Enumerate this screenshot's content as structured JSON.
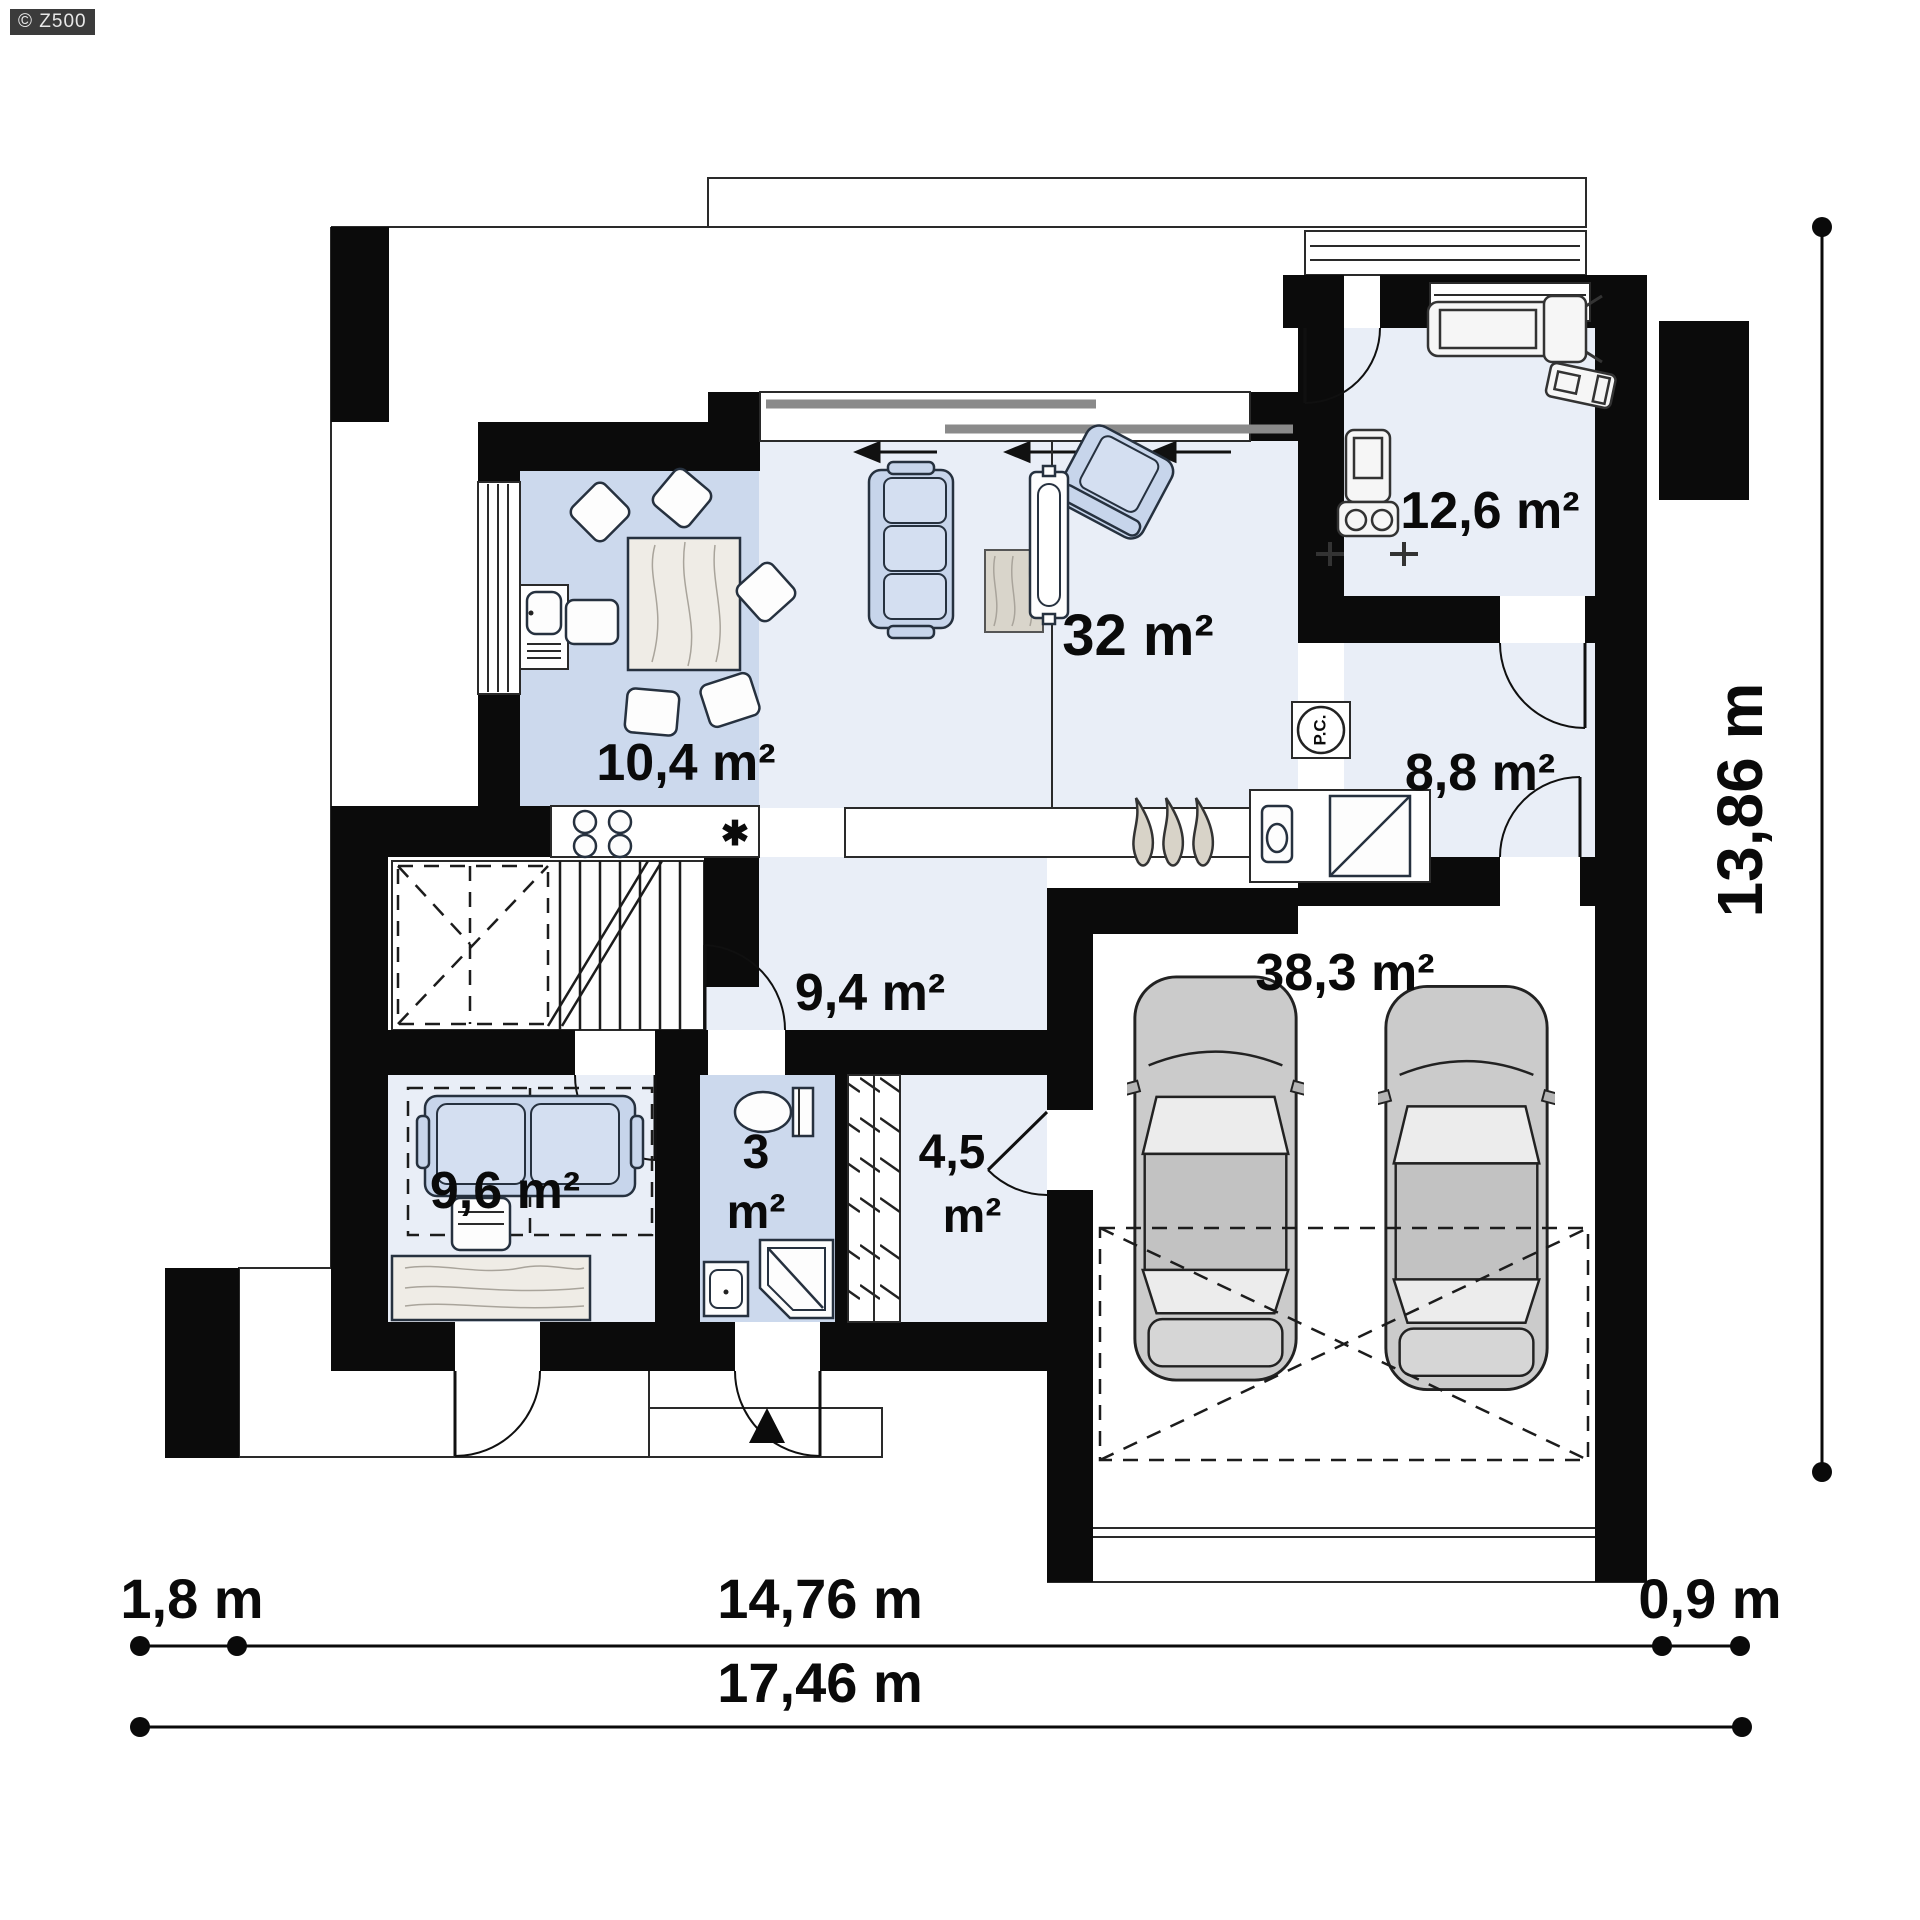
{
  "watermark": {
    "text": "© Z500"
  },
  "rooms": {
    "kitchen": {
      "label": "10,4 m²"
    },
    "living_room": {
      "label": "32 m²"
    },
    "gym": {
      "label": "12,6 m²"
    },
    "utility_room": {
      "label": "8,8 m²"
    },
    "hallway": {
      "label": "9,4 m²"
    },
    "office": {
      "label": "9,6 m²"
    },
    "bathroom": {
      "value": "3",
      "unit": "m²"
    },
    "wardrobe": {
      "value": "4,5",
      "unit": "m²"
    },
    "garage": {
      "label": "38,3 m²"
    }
  },
  "equipment": {
    "boiler_label": "P.C.",
    "sink_marker": "✱"
  },
  "dimensions": {
    "left_offset": "1,8 m",
    "main_width": "14,76 m",
    "right_offset": "0,9 m",
    "total_width": "17,46 m",
    "total_height": "13,86 m"
  }
}
